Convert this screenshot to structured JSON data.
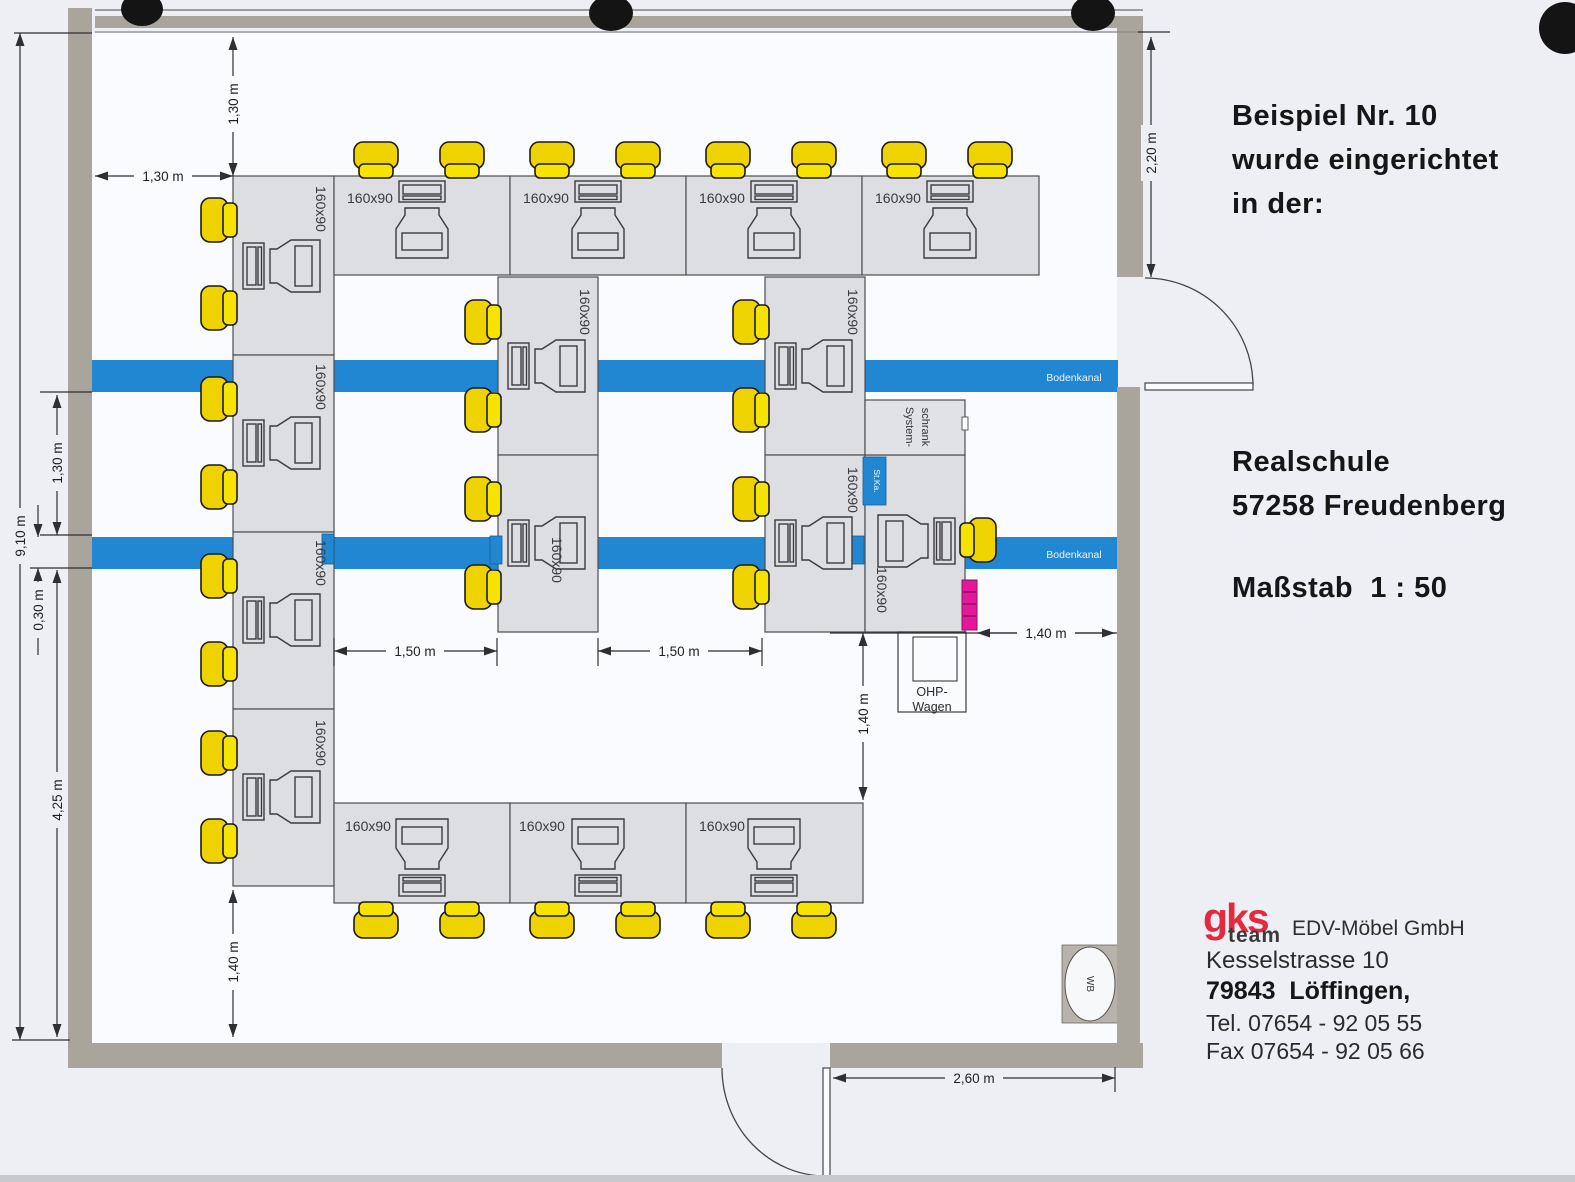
{
  "panel": {
    "title": [
      "Beispiel Nr. 10",
      "wurde eingerichtet",
      "in der:"
    ],
    "location": [
      "Realschule",
      "57258 Freudenberg"
    ],
    "scale": "Maßstab  1 : 50",
    "company": {
      "logo_main": "gks",
      "logo_sub": "team",
      "name": "EDV-Möbel GmbH",
      "street": "Kesselstrasse 10",
      "city": "79843  Löffingen,",
      "tel": "Tel. 07654 - 92 05 55",
      "fax": "Fax 07654 - 92 05 66"
    }
  },
  "plan": {
    "desk_size_label": "160x90",
    "floor_channel_label": "Bodenkanal",
    "system_cabinet_label": [
      "System-",
      "schrank"
    ],
    "st_ka_label": "St.Ka.",
    "ohp_label": [
      "OHP-",
      "Wagen"
    ],
    "wash_basin_label": "WB",
    "dimensions": {
      "d130": "1,30 m",
      "d220": "2,20 m",
      "d910": "9,10 m",
      "d030": "0,30 m",
      "d425": "4,25 m",
      "d140": "1,40 m",
      "d150": "1,50 m",
      "d260": "2,60 m"
    }
  },
  "colors": {
    "channel_blue": "#2187d2",
    "chair_yellow": "#f6e300",
    "chair_yellow_dark": "#eed300",
    "wall_gray": "#a9a49c",
    "desk_gray": "#dcdee1",
    "floor_white": "#fafbfe",
    "page_bg": "#edeff5",
    "printer_magenta": "#e3189a",
    "logo_red": "#e5293f",
    "line_dark": "#2e2e33"
  }
}
